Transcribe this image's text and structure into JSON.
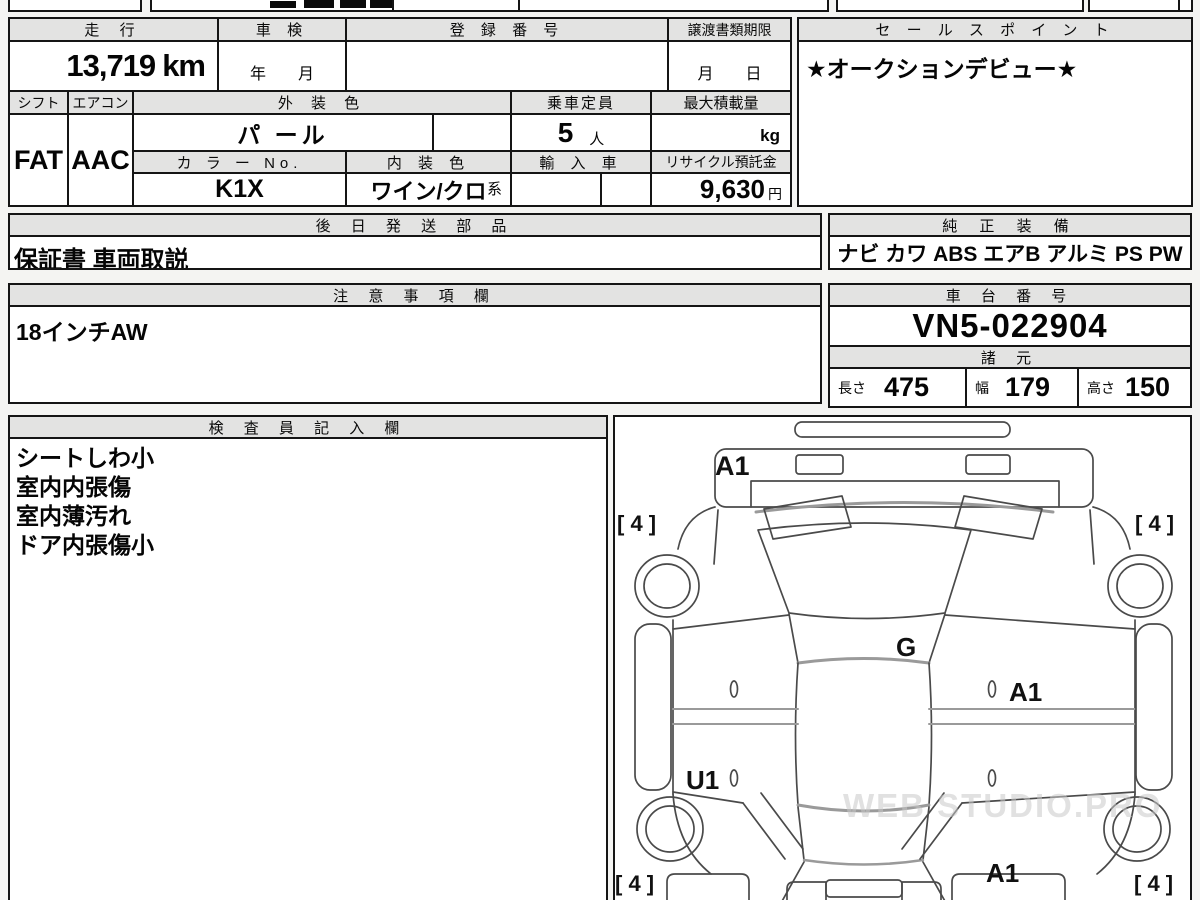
{
  "sheet": {
    "mileage": {
      "label": "走 行",
      "value": "13,719",
      "unit": "km"
    },
    "shaken": {
      "label": "車 検",
      "value": "年　　月"
    },
    "registration": {
      "label": "登 録 番 号",
      "value": ""
    },
    "transfer_deadline": {
      "label": "譲渡書類期限",
      "value": "月　　日"
    },
    "sales_point": {
      "label": "セ ー ル ス ポ イ ン ト",
      "value": "★オークションデビュー★"
    },
    "shift": {
      "label": "シフト",
      "value": "FAT"
    },
    "aircon": {
      "label": "エアコン",
      "value": "AAC"
    },
    "exterior_color": {
      "label": "外 装 色",
      "value": "パ ール"
    },
    "capacity": {
      "label": "乗車定員",
      "value": "5",
      "unit": "人"
    },
    "max_load": {
      "label": "最大積載量",
      "unit": "kg"
    },
    "color_no": {
      "label": "カ ラ ー No.",
      "value": "K1X"
    },
    "interior_color": {
      "label": "内 装 色",
      "value": "ワイン/クロ",
      "suffix": "系"
    },
    "import_car": {
      "label": "輸 入 車"
    },
    "recycle_deposit": {
      "label": "リサイクル預託金",
      "value": "9,630",
      "unit": "円"
    },
    "later_parts": {
      "label": "後 日 発 送 部 品",
      "value": "保証書 車両取説"
    },
    "equipment": {
      "label": "純 正 装 備",
      "value": "ナビ カワ ABS エアB アルミ PS PW"
    },
    "notes": {
      "label": "注 意 事 項 欄",
      "value": "18インチAW"
    },
    "chassis": {
      "label": "車 台 番 号",
      "value": "VN5-022904"
    },
    "specs": {
      "label": "諸 元",
      "length": {
        "label": "長さ",
        "value": "475"
      },
      "width": {
        "label": "幅",
        "value": "179"
      },
      "height": {
        "label": "高さ",
        "value": "150"
      }
    },
    "inspector": {
      "label": "検 査 員 記 入 欄",
      "notes": [
        "シートしわ小",
        "室内内張傷",
        "室内薄汚れ",
        "ドア内張傷小"
      ]
    }
  },
  "diagram": {
    "marks": {
      "hood": "A1",
      "tread_front_left": "[ 4 ]",
      "tread_front_right": "[ 4 ]",
      "roof": "G",
      "door_right": "A1",
      "door_rear_left": "U1",
      "rear_fender_right": "A1",
      "tread_rear_left": "[ 4 ]",
      "tread_rear_right": "[ 4 ]"
    },
    "watermark": "WEB STUDIO.PRO"
  }
}
